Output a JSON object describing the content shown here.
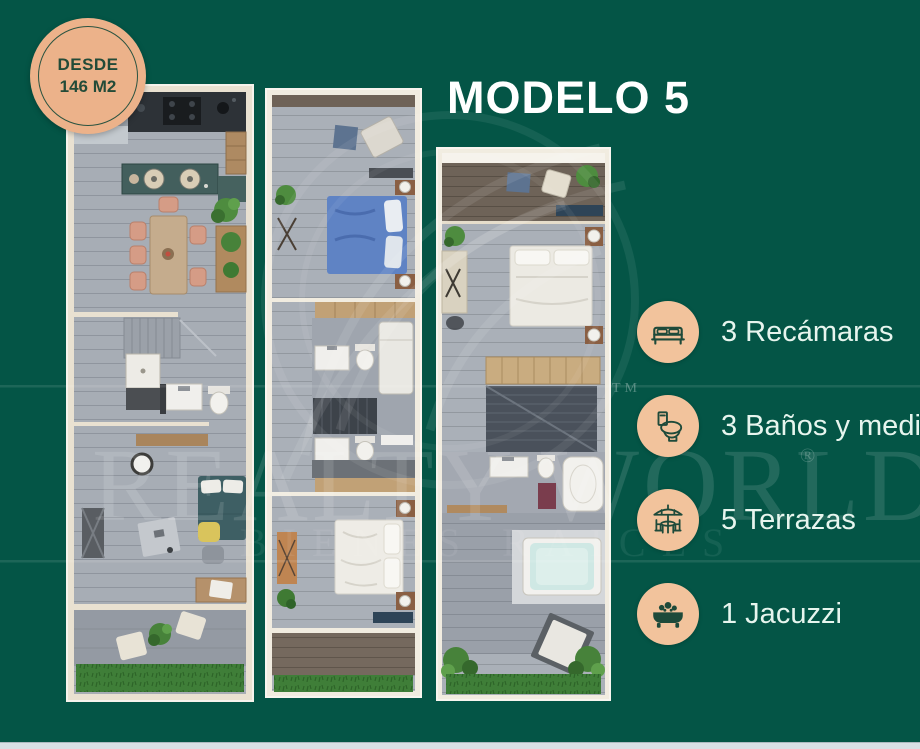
{
  "title": "MODELO 5",
  "badge": {
    "line1": "DESDE",
    "line2": "146 M2"
  },
  "features": [
    {
      "icon": "bed-icon",
      "label": "3 Recámaras"
    },
    {
      "icon": "toilet-icon",
      "label": "3 Baños y medio"
    },
    {
      "icon": "umbrella-table-icon",
      "label": "5 Terrazas"
    },
    {
      "icon": "bathtub-icon",
      "label": "1 Jacuzzi"
    }
  ],
  "watermark": {
    "brand": "REALTY WORLD",
    "registered": "®",
    "trademark": "TM",
    "tagline": "BIENES RAICES"
  },
  "colors": {
    "background": "#045546",
    "badge_fill": "#ecb28a",
    "icon_circle_fill": "#f2c39c",
    "accent_dark_green": "#1e4a3a",
    "title_text": "#ffffff",
    "feature_text": "#e7f5ee"
  }
}
